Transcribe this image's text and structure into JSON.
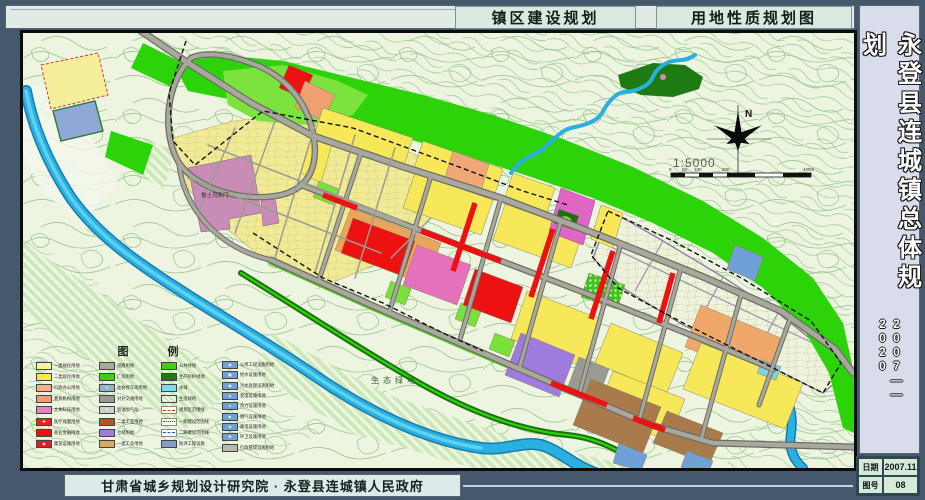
{
  "titles": {
    "left_box": "镇区建设规划",
    "right_box": "用地性质规划图"
  },
  "sidebar": {
    "title": "永登县连城镇总体规划",
    "period": "2007——2020",
    "info": {
      "date_label": "日期",
      "date_value": "2007.11",
      "no_label": "图号",
      "no_value": "08"
    }
  },
  "footer": {
    "credit": "甘肃省城乡规划设计研究院 · 永登县连城镇人民政府"
  },
  "map": {
    "landmark_label": "鲁土司衙门",
    "eco_label": "生态绿地",
    "compass": {
      "north": "N",
      "scale_text": "1:5000",
      "ticks": [
        "0",
        "50",
        "100",
        "200",
        "400m"
      ]
    },
    "legend": {
      "title": "图　例",
      "columns": [
        [
          {
            "t": "一类居住用地",
            "c": "#f8f2a2"
          },
          {
            "t": "二类居住用地",
            "c": "#f6e84e"
          },
          {
            "t": "行政办公用地",
            "c": "#f5b183"
          },
          {
            "t": "教育机构用地",
            "c": "#f09f6a"
          },
          {
            "t": "文体科技用地",
            "c": "#e87fc8"
          },
          {
            "t": "医疗保健用地",
            "c": "#e42222",
            "icon": "✚"
          },
          {
            "t": "商业金融用地",
            "c": "#ee1111"
          },
          {
            "t": "集贸设施用地",
            "c": "#d81f2a",
            "icon": "◆"
          }
        ],
        [
          {
            "t": "道路用地",
            "c": "#a8a8a0"
          },
          {
            "t": "广场用地",
            "c": "#3fd014"
          },
          {
            "t": "社会停车场用地",
            "c": "#8fb6c8",
            "icon": "P"
          },
          {
            "t": "对外交通用地",
            "c": "#9a9a92"
          },
          {
            "t": "加油加气站",
            "c": "#c8d0d0",
            "icon": "P"
          },
          {
            "t": "二类工业用地",
            "c": "#b8502a"
          },
          {
            "t": "仓储用地",
            "c": "#9e7bdc"
          },
          {
            "t": "一类工业用地",
            "c": "#d8a868"
          }
        ],
        [
          {
            "t": "公共绿地",
            "c": "#3fd014"
          },
          {
            "t": "生产防护绿地",
            "c": "#1f7a12"
          },
          {
            "t": "水域",
            "c": "#7fd9ef"
          },
          {
            "t": "生态绿地",
            "style": "hatch"
          },
          {
            "t": "规划区范围线",
            "style": "dash-red"
          },
          {
            "t": "一期建设范围线",
            "style": "dashdot-red"
          },
          {
            "t": "二期建设范围线",
            "style": "dash-blue"
          },
          {
            "t": "防洪工程设施",
            "c": "#7f9fc8"
          }
        ],
        [
          {
            "t": "公用工程设施用地",
            "c": "#6fa0d8",
            "icon": "◉"
          },
          {
            "t": "给水设施用地",
            "c": "#6fa0d8",
            "icon": "▣"
          },
          {
            "t": "污水处理设施用地",
            "c": "#6fa0d8",
            "icon": "◆"
          },
          {
            "t": "变电设施用地",
            "c": "#6fa0d8",
            "icon": "▲"
          },
          {
            "t": "热力设施用地",
            "c": "#6fa0d8",
            "icon": "●"
          },
          {
            "t": "燃气设施用地",
            "c": "#6fa0d8",
            "icon": "■"
          },
          {
            "t": "邮电设施用地",
            "c": "#6fa0d8",
            "icon": "◈"
          },
          {
            "t": "环卫设施用地",
            "c": "#6fa0d8",
            "icon": "✚"
          },
          {
            "t": "行政管理设施用地",
            "c": "#b8b8b0"
          }
        ]
      ]
    }
  },
  "palette": {
    "residential_1": "#f8f2a2",
    "residential_2": "#f6e84e",
    "admin": "#f5b183",
    "education": "#f09f6a",
    "culture": "#e066c6",
    "commercial": "#ee1111",
    "market": "#e570bb",
    "industry": "#a87a4c",
    "warehouse": "#9e7bdc",
    "utility": "#6fa0d8",
    "green_public": "#2cd309",
    "green_protect": "#1e7a12",
    "water": "#2ab0e0",
    "road": "#a8a89e",
    "landmark": "#c78db6",
    "outer_frame": "#46586c"
  }
}
